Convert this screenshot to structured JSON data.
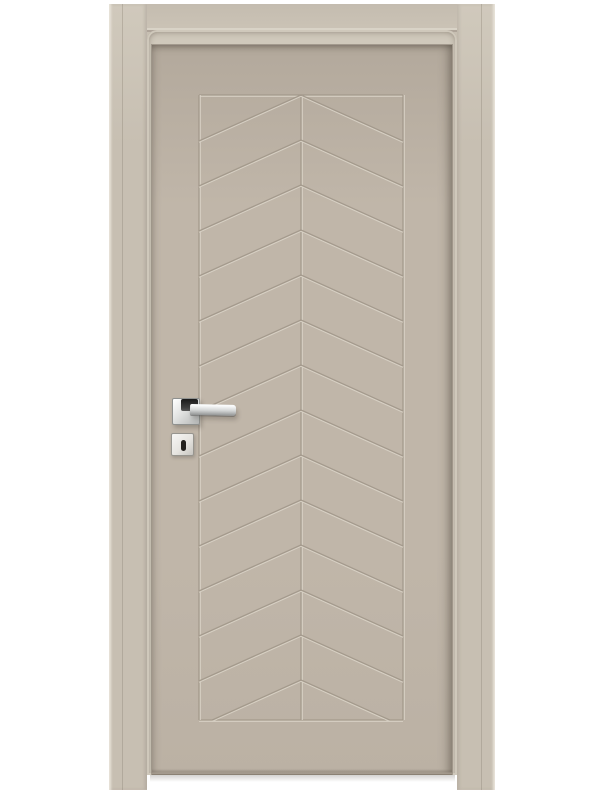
{
  "colors": {
    "background": "#ffffff",
    "frame_face": "#c7bfb2",
    "frame_face_light": "#d0c9bc",
    "frame_highlight": "#e9e4da",
    "frame_seam": "#a89e92",
    "leaf_top": "#b3a99c",
    "leaf_mid": "#c0b6a9",
    "leaf_low": "#bbb1a4",
    "leaf_bottom_edge": "#a69c8f",
    "groove": "#a1978a",
    "groove_light": "#d9d3c7",
    "chrome_light": "#fafbfb",
    "chrome_mid": "#d2d4d4",
    "chrome_dark": "#8f9191",
    "handle_neck_dark": "#1a1a1a",
    "escutcheon_face": "#f7f6f4",
    "keyhole": "#24211e"
  },
  "pattern": {
    "left": 199,
    "right": 403,
    "top": 95,
    "bottom": 720,
    "center_x": 301,
    "apex_start_y": 95,
    "apex_spacing": 45,
    "apex_count": 14,
    "side_drop": 46,
    "stroke_width": 1.3,
    "groove_color": "#a1978a",
    "bevel_color": "#d9d3c7",
    "direction": "chevrons-point-up"
  }
}
